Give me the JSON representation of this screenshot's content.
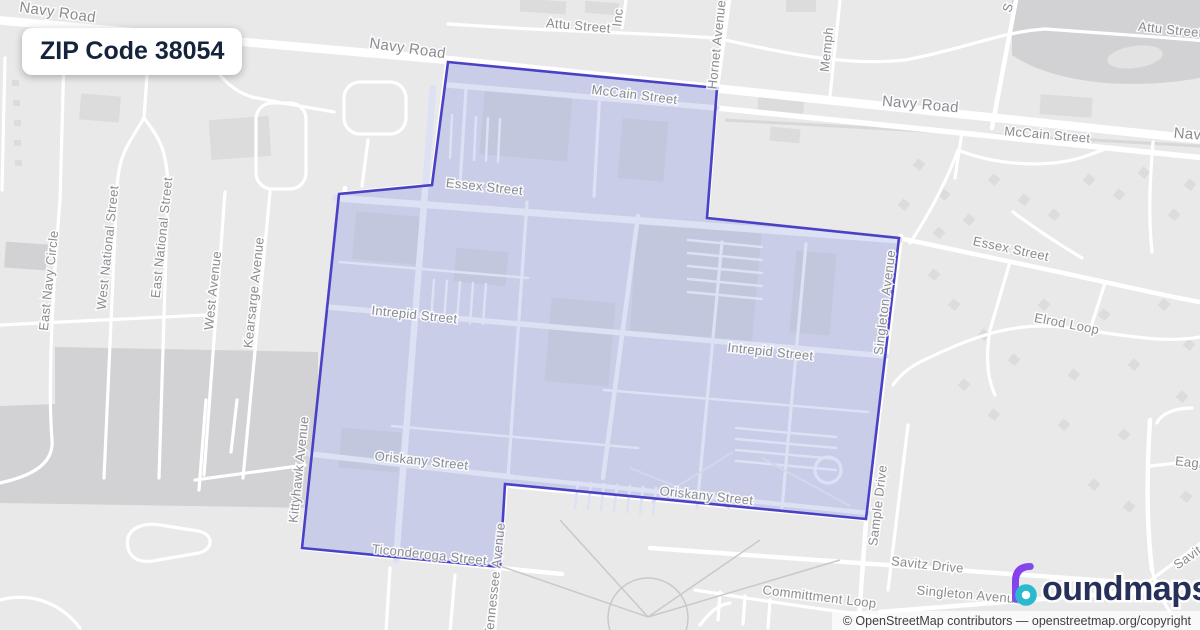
{
  "badge": {
    "label": "ZIP Code 38054"
  },
  "logo": {
    "icon": "boundmaps-drop-icon",
    "text": "oundmaps",
    "full_name": "boundmaps"
  },
  "attribution": {
    "text": "© OpenStreetMap contributors — openstreetmap.org/copyright"
  },
  "map": {
    "region": {
      "name": "ZIP Code 38054 boundary",
      "zip": "38054"
    },
    "street_labels": [
      {
        "id": "navy-road-1",
        "text": "Navy Road",
        "x": 57,
        "y": 17,
        "r": 8,
        "big": true
      },
      {
        "id": "navy-road-2",
        "text": "Navy Road",
        "x": 407,
        "y": 53,
        "r": 8,
        "big": true
      },
      {
        "id": "navy-road-3",
        "text": "Navy Road",
        "x": 920,
        "y": 109,
        "r": 5,
        "big": true
      },
      {
        "id": "navy-road-4",
        "text": "Navy",
        "x": 1191,
        "y": 139,
        "r": 5,
        "big": true
      },
      {
        "id": "attu-street-1",
        "text": "Attu Street",
        "x": 578,
        "y": 30,
        "r": 5
      },
      {
        "id": "attu-street-2",
        "text": "Attu Street",
        "x": 1170,
        "y": 34,
        "r": 6
      },
      {
        "id": "mccain-street-1",
        "text": "McCain Street",
        "x": 634,
        "y": 99,
        "r": 7
      },
      {
        "id": "mccain-street-2",
        "text": "McCain Street",
        "x": 1047,
        "y": 139,
        "r": 5
      },
      {
        "id": "inc-street",
        "text": "Inc",
        "x": 622,
        "y": 18,
        "r": -84
      },
      {
        "id": "hornet-avenue",
        "text": "Hornet Avenue",
        "x": 721,
        "y": 45,
        "r": -84
      },
      {
        "id": "memphis",
        "text": "Memph",
        "x": 831,
        "y": 50,
        "r": -84
      },
      {
        "id": "s-street",
        "text": "S",
        "x": 1012,
        "y": 9,
        "r": -72
      },
      {
        "id": "essex-street-1",
        "text": "Essex Street",
        "x": 484,
        "y": 191,
        "r": 6
      },
      {
        "id": "essex-street-2",
        "text": "Essex Street",
        "x": 1010,
        "y": 253,
        "r": 12
      },
      {
        "id": "elrod-loop",
        "text": "Elrod Loop",
        "x": 1066,
        "y": 328,
        "r": 11
      },
      {
        "id": "intrepid-street-1",
        "text": "Intrepid Street",
        "x": 414,
        "y": 319,
        "r": 6
      },
      {
        "id": "intrepid-street-2",
        "text": "Intrepid Street",
        "x": 770,
        "y": 356,
        "r": 6
      },
      {
        "id": "oriskany-street-1",
        "text": "Oriskany Street",
        "x": 421,
        "y": 465,
        "r": 6
      },
      {
        "id": "oriskany-street-2",
        "text": "Oriskany Street",
        "x": 706,
        "y": 500,
        "r": 6
      },
      {
        "id": "ticonderoga-street",
        "text": "Ticonderoga Street",
        "x": 429,
        "y": 559,
        "r": 6
      },
      {
        "id": "kittyhawk-avenue",
        "text": "Kittyhawk Avenue",
        "x": 303,
        "y": 470,
        "r": -84
      },
      {
        "id": "tennessee-avenue",
        "text": "Tennessee Avenue",
        "x": 499,
        "y": 580,
        "r": -84
      },
      {
        "id": "singleton-avenue-1",
        "text": "Singleton Avenue",
        "x": 889,
        "y": 303,
        "r": -83
      },
      {
        "id": "sample-drive",
        "text": "Sample Drive",
        "x": 882,
        "y": 506,
        "r": -83
      },
      {
        "id": "savitz-drive",
        "text": "Savitz Drive",
        "x": 927,
        "y": 569,
        "r": 6
      },
      {
        "id": "singleton-avenue-2",
        "text": "Singleton Avenue",
        "x": 969,
        "y": 599,
        "r": 5
      },
      {
        "id": "committment-loop",
        "text": "Committment Loop",
        "x": 819,
        "y": 601,
        "r": 7
      },
      {
        "id": "eagle",
        "text": "Eagle",
        "x": 1192,
        "y": 467,
        "r": 6
      },
      {
        "id": "savit",
        "text": "Savit",
        "x": 1190,
        "y": 561,
        "r": -35
      },
      {
        "id": "east-navy-circle",
        "text": "East Navy Circle",
        "x": 53,
        "y": 281,
        "r": -84
      },
      {
        "id": "west-national-street",
        "text": "West National Street",
        "x": 112,
        "y": 248,
        "r": -84
      },
      {
        "id": "east-national-street",
        "text": "East National Street",
        "x": 166,
        "y": 238,
        "r": -84
      },
      {
        "id": "west-avenue",
        "text": "West Avenue",
        "x": 217,
        "y": 291,
        "r": -84
      },
      {
        "id": "kearsarge-avenue",
        "text": "Kearsarge Avenue",
        "x": 258,
        "y": 293,
        "r": -84
      }
    ]
  },
  "colors": {
    "map_background": "#e9e9ea",
    "road": "#ffffff",
    "block_dark": "#d2d2d4",
    "building_outside": "#dcdcdd",
    "region_fill": "#c9cde7",
    "region_stroke": "#4a41c5",
    "inner_road": "#dde1f4",
    "building_inside": "#c2c7dd",
    "street_label": "#8b8b92",
    "badge_text": "#15233c",
    "logo_text": "#273058",
    "logo_purple": "#9333ea",
    "logo_indigo": "#6366f1",
    "logo_teal": "#2ab9cf",
    "attribution_bg": "rgba(255,255,255,0.72)",
    "attribution_text": "#3f3f3f"
  }
}
